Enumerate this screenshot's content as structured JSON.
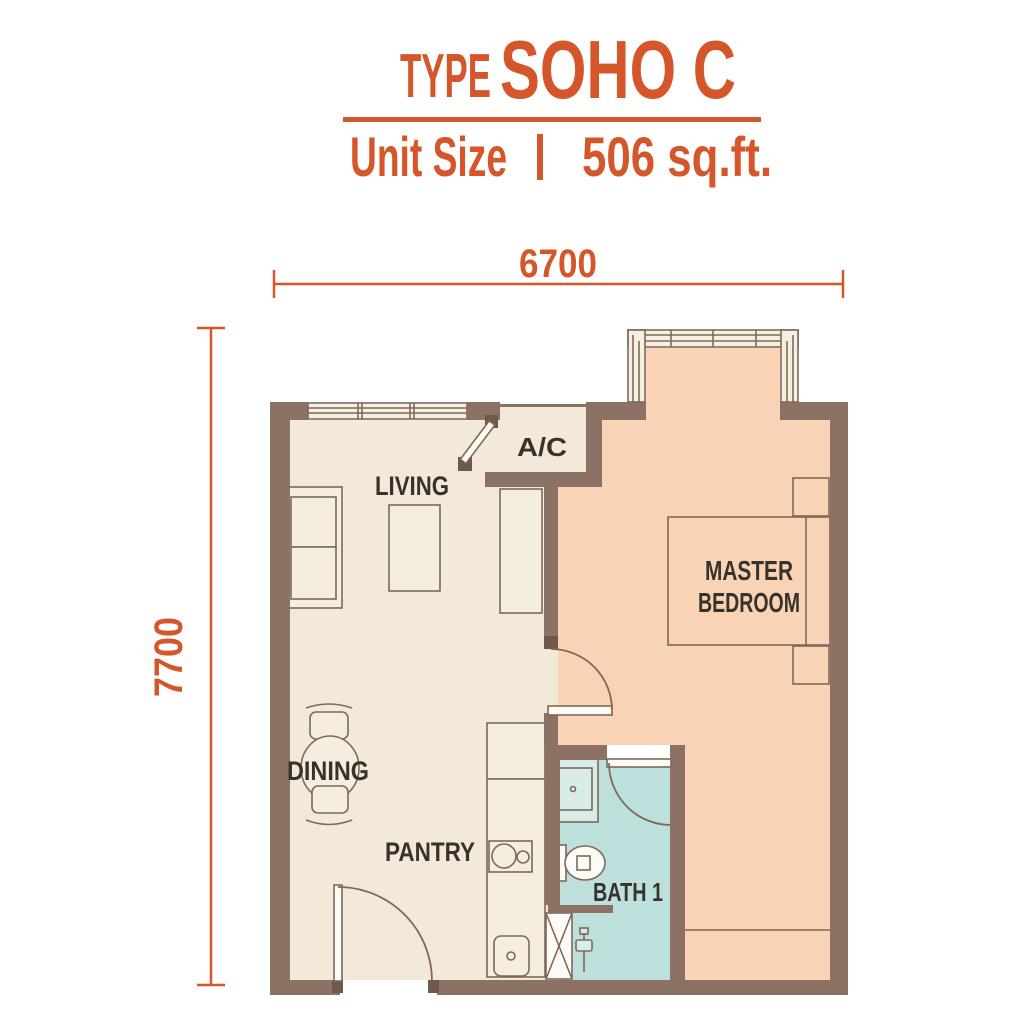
{
  "header": {
    "type_label": "TYPE",
    "plan_name": "SOHO C",
    "unit_size_label": "Unit Size",
    "separator": "|",
    "unit_size_value": "506 sq.ft."
  },
  "dimensions": {
    "width": "6700",
    "height": "7700"
  },
  "rooms": {
    "living": {
      "label": "LIVING"
    },
    "ac_ledge": {
      "label": "A/C"
    },
    "master_bedroom": {
      "line1": "MASTER",
      "line2": "BEDROOM"
    },
    "dining": {
      "label": "DINING"
    },
    "pantry": {
      "label": "PANTRY"
    },
    "bath_1": {
      "label": "BATH 1"
    }
  },
  "colors": {
    "accent_orange": "#D5562B",
    "wall_brown": "#8C7264",
    "floor_cream": "#F2E9D8",
    "floor_peach": "#F9D3B5",
    "floor_bath_blue": "#BEE0DC",
    "label_dark": "#38322C",
    "background": "#FFFFFF"
  }
}
